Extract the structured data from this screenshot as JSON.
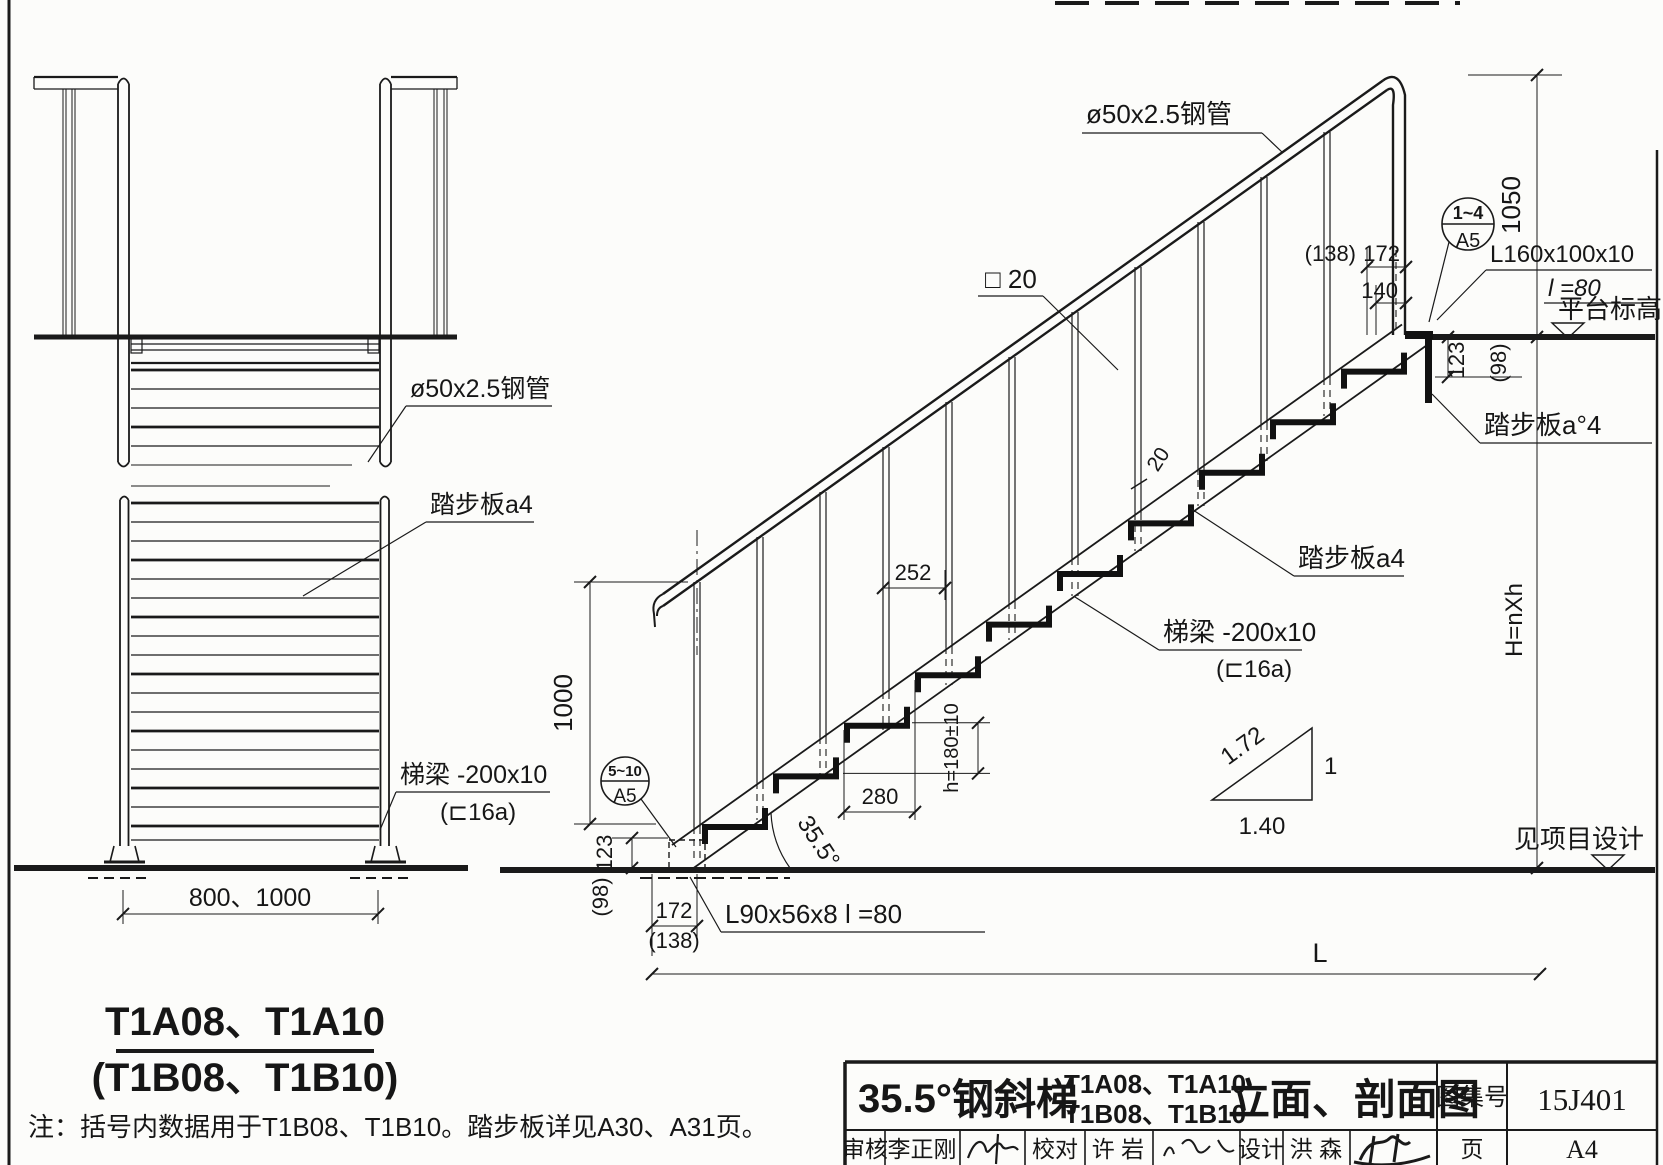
{
  "front_view": {
    "label_handrail": "ø50x2.5钢管",
    "label_tread": "踏步板a4",
    "label_stringer": "梯梁 -200x10",
    "label_stringer2": "(⊏16a)",
    "dim_width": "800、1000",
    "title1": "T1A08、T1A10",
    "title2": "(T1B08、T1B10)"
  },
  "section_view": {
    "label_handrail": "ø50x2.5钢管",
    "label_square_bar": "□ 20",
    "dim_square_bar": "20",
    "label_top_angle": "L160x100x10",
    "label_top_angle_len": "l =80",
    "label_platform": "平台标高",
    "label_top_tread": "踏步板a°4",
    "label_mid_tread": "踏步板a4",
    "label_stringer": "梯梁 -200x10",
    "label_stringer2": "(⊏16a)",
    "label_bottom_angle": "L90x56x8  l =80",
    "label_see_project": "见项目设计",
    "dim_1050": "1050",
    "dim_1000": "1000",
    "dim_252": "252",
    "dim_280": "280",
    "dim_step": "h=180±10",
    "dim_angle": "35.5°",
    "dim_138_top": "(138)",
    "dim_172_top": "172",
    "dim_140_top": "140",
    "dim_123_top": "123",
    "dim_98_top": "(98)",
    "dim_123_bot": "123",
    "dim_98_bot": "(98)",
    "dim_172_bot": "172",
    "dim_138_bot": "(138)",
    "dim_L": "L",
    "dim_H": "H=nXh",
    "detail_top_range": "1~4",
    "detail_top_sheet": "A5",
    "detail_bot_range": "5~10",
    "detail_bot_sheet": "A5",
    "slope_hyp": "1.72",
    "slope_v": "1",
    "slope_h": "1.40"
  },
  "note": "注：括号内数据用于T1B08、T1B10。踏步板详见A30、A31页。",
  "title_block": {
    "angle": "35.5°",
    "product": "钢斜梯",
    "models1": "T1A08、T1A10",
    "models2": "T1B08、T1B10",
    "view_name": "立面、剖面图",
    "atlas_label": "图集号",
    "atlas_no": "15J401",
    "review_label": "审核",
    "reviewer": "李正刚",
    "check_label": "校对",
    "checker": "许  岩",
    "design_label": "设计",
    "designer": "洪  森",
    "page_label": "页",
    "page_no": "A4"
  }
}
